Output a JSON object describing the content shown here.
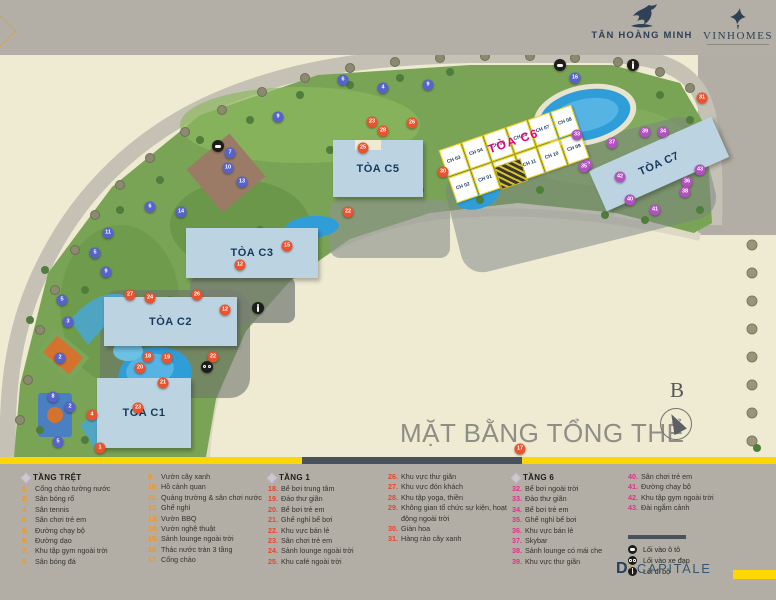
{
  "header": {
    "thm_logo": "TÂN HOÀNG MINH",
    "vinhomes_logo": "VINHOMES"
  },
  "map": {
    "title": "MẶT BẰNG TỔNG THỂ",
    "compass_label": "B",
    "buildings": {
      "c1": "TÒA C1",
      "c2": "TÒA C2",
      "c3": "TÒA C3",
      "c5": "TÒA C5",
      "c6": "TÒA C6",
      "c7": "TÒA C7"
    },
    "c6_units": [
      "CH 03",
      "CH 04",
      "CH 05",
      "CH 06",
      "CH 07",
      "CH 08",
      "CH 02",
      "CH 01",
      "CH 12",
      "CH 11",
      "CH 10",
      "CH 09"
    ],
    "markers": [
      {
        "c": "b",
        "n": "6",
        "x": 343,
        "y": 80
      },
      {
        "c": "b",
        "n": "4",
        "x": 383,
        "y": 88
      },
      {
        "c": "b",
        "n": "9",
        "x": 428,
        "y": 85
      },
      {
        "c": "b",
        "n": "9",
        "x": 278,
        "y": 117
      },
      {
        "c": "b",
        "n": "7",
        "x": 230,
        "y": 153
      },
      {
        "c": "b",
        "n": "10",
        "x": 228,
        "y": 168
      },
      {
        "c": "b",
        "n": "13",
        "x": 242,
        "y": 182
      },
      {
        "c": "b",
        "n": "6",
        "x": 150,
        "y": 207
      },
      {
        "c": "b",
        "n": "14",
        "x": 181,
        "y": 212
      },
      {
        "c": "b",
        "n": "11",
        "x": 108,
        "y": 233
      },
      {
        "c": "b",
        "n": "5",
        "x": 95,
        "y": 253
      },
      {
        "c": "b",
        "n": "9",
        "x": 106,
        "y": 272
      },
      {
        "c": "b",
        "n": "5",
        "x": 62,
        "y": 300
      },
      {
        "c": "b",
        "n": "3",
        "x": 68,
        "y": 322
      },
      {
        "c": "b",
        "n": "2",
        "x": 60,
        "y": 358
      },
      {
        "c": "b",
        "n": "8",
        "x": 53,
        "y": 397
      },
      {
        "c": "b",
        "n": "2",
        "x": 70,
        "y": 407
      },
      {
        "c": "b",
        "n": "5",
        "x": 58,
        "y": 442
      },
      {
        "c": "b",
        "n": "16",
        "x": 575,
        "y": 78
      },
      {
        "c": "o",
        "n": "23",
        "x": 372,
        "y": 122
      },
      {
        "c": "o",
        "n": "26",
        "x": 412,
        "y": 123
      },
      {
        "c": "o",
        "n": "28",
        "x": 383,
        "y": 131
      },
      {
        "c": "o",
        "n": "25",
        "x": 363,
        "y": 148
      },
      {
        "c": "o",
        "n": "30",
        "x": 443,
        "y": 172
      },
      {
        "c": "o",
        "n": "22",
        "x": 348,
        "y": 212
      },
      {
        "c": "o",
        "n": "12",
        "x": 240,
        "y": 265
      },
      {
        "c": "o",
        "n": "15",
        "x": 287,
        "y": 246
      },
      {
        "c": "o",
        "n": "27",
        "x": 130,
        "y": 295
      },
      {
        "c": "o",
        "n": "24",
        "x": 150,
        "y": 298
      },
      {
        "c": "o",
        "n": "26",
        "x": 197,
        "y": 295
      },
      {
        "c": "o",
        "n": "18",
        "x": 148,
        "y": 357
      },
      {
        "c": "o",
        "n": "19",
        "x": 167,
        "y": 358
      },
      {
        "c": "o",
        "n": "20",
        "x": 140,
        "y": 368
      },
      {
        "c": "o",
        "n": "21",
        "x": 163,
        "y": 383
      },
      {
        "c": "o",
        "n": "23",
        "x": 138,
        "y": 408
      },
      {
        "c": "o",
        "n": "4",
        "x": 92,
        "y": 415
      },
      {
        "c": "o",
        "n": "1",
        "x": 100,
        "y": 448
      },
      {
        "c": "o",
        "n": "22",
        "x": 213,
        "y": 357
      },
      {
        "c": "o",
        "n": "12",
        "x": 225,
        "y": 310
      },
      {
        "c": "o",
        "n": "31",
        "x": 702,
        "y": 98
      },
      {
        "c": "o",
        "n": "17",
        "x": 520,
        "y": 449
      },
      {
        "c": "p",
        "n": "33",
        "x": 577,
        "y": 135
      },
      {
        "c": "p",
        "n": "32",
        "x": 587,
        "y": 165
      },
      {
        "c": "p",
        "n": "37",
        "x": 612,
        "y": 143
      },
      {
        "c": "p",
        "n": "39",
        "x": 645,
        "y": 132
      },
      {
        "c": "p",
        "n": "34",
        "x": 663,
        "y": 132
      },
      {
        "c": "p",
        "n": "36",
        "x": 687,
        "y": 182
      },
      {
        "c": "p",
        "n": "38",
        "x": 685,
        "y": 192
      },
      {
        "c": "p",
        "n": "40",
        "x": 630,
        "y": 200
      },
      {
        "c": "p",
        "n": "41",
        "x": 655,
        "y": 210
      },
      {
        "c": "p",
        "n": "35",
        "x": 584,
        "y": 167
      },
      {
        "c": "p",
        "n": "42",
        "x": 620,
        "y": 177
      },
      {
        "c": "p",
        "n": "43",
        "x": 700,
        "y": 170
      },
      {
        "c": "k",
        "n": "car",
        "x": 218,
        "y": 146
      },
      {
        "c": "k",
        "n": "car",
        "x": 560,
        "y": 65
      },
      {
        "c": "k",
        "n": "walk",
        "x": 633,
        "y": 65
      },
      {
        "c": "k",
        "n": "walk",
        "x": 258,
        "y": 308
      },
      {
        "c": "k",
        "n": "bike",
        "x": 207,
        "y": 367
      }
    ]
  },
  "legend": {
    "columns": [
      {
        "header": "TẦNG TRỆT",
        "color": "#f7941d",
        "x": 22,
        "w": 122,
        "items": [
          {
            "n": "1.",
            "t": "Cổng chào tường nước"
          },
          {
            "n": "2.",
            "t": "Sân bóng rổ"
          },
          {
            "n": "3.",
            "t": "Sân tennis"
          },
          {
            "n": "4.",
            "t": "Sân chơi trẻ em"
          },
          {
            "n": "5.",
            "t": "Đường chạy bộ"
          },
          {
            "n": "6.",
            "t": "Đường dạo"
          },
          {
            "n": "7.",
            "t": "Khu tập gym ngoài trời"
          },
          {
            "n": "8.",
            "t": "Sân bóng đá"
          }
        ]
      },
      {
        "header": "",
        "color": "#f7941d",
        "x": 148,
        "w": 118,
        "items": [
          {
            "n": "9.",
            "t": "Vườn cây xanh"
          },
          {
            "n": "10.",
            "t": "Hồ cảnh quan"
          },
          {
            "n": "11.",
            "t": "Quảng trường & sân chơi nước"
          },
          {
            "n": "12.",
            "t": "Ghế nghỉ"
          },
          {
            "n": "13.",
            "t": "Vườn BBQ"
          },
          {
            "n": "14.",
            "t": "Vườn nghệ thuật"
          },
          {
            "n": "15.",
            "t": "Sảnh lounge ngoài trời"
          },
          {
            "n": "16.",
            "t": "Thác nước tràn 3 tầng"
          },
          {
            "n": "17.",
            "t": "Cổng chào"
          }
        ]
      },
      {
        "header": "TẦNG 1",
        "color": "#e8432e",
        "x": 268,
        "w": 118,
        "items": [
          {
            "n": "18.",
            "t": "Bể bơi trung tâm"
          },
          {
            "n": "19.",
            "t": "Đảo thư giãn"
          },
          {
            "n": "20.",
            "t": "Bể bơi trẻ em"
          },
          {
            "n": "21.",
            "t": "Ghế nghỉ bể bơi"
          },
          {
            "n": "22.",
            "t": "Khu vực bán lẻ"
          },
          {
            "n": "23.",
            "t": "Sân chơi trẻ em"
          },
          {
            "n": "24.",
            "t": "Sảnh lounge ngoài trời"
          },
          {
            "n": "25.",
            "t": "Khu café ngoài trời"
          }
        ]
      },
      {
        "header": "",
        "color": "#e8432e",
        "x": 388,
        "w": 122,
        "items": [
          {
            "n": "26.",
            "t": "Khu vực thư giãn"
          },
          {
            "n": "27.",
            "t": "Khu vực đón khách"
          },
          {
            "n": "28.",
            "t": "Khu tập yoga, thiền"
          },
          {
            "n": "29.",
            "t": "Không gian tổ chức sự kiện, hoạt động ngoài trời"
          },
          {
            "n": "30.",
            "t": "Giàn hoa"
          },
          {
            "n": "31.",
            "t": "Hàng rào cây xanh"
          }
        ]
      },
      {
        "header": "TẦNG 6",
        "color": "#e0308a",
        "x": 512,
        "w": 114,
        "items": [
          {
            "n": "32.",
            "t": "Bể bơi ngoài trời"
          },
          {
            "n": "33.",
            "t": "Đảo thư giãn"
          },
          {
            "n": "34.",
            "t": "Bể bơi trẻ em"
          },
          {
            "n": "35.",
            "t": "Ghế nghỉ bể bơi"
          },
          {
            "n": "36.",
            "t": "Khu vực bán lẻ"
          },
          {
            "n": "37.",
            "t": "Skybar"
          },
          {
            "n": "38.",
            "t": "Sảnh lounge có mái che"
          },
          {
            "n": "39.",
            "t": "Khu vực thư giãn"
          }
        ]
      },
      {
        "header": "",
        "color": "#e0308a",
        "x": 628,
        "w": 148,
        "items": [
          {
            "n": "40.",
            "t": "Sân chơi trẻ em"
          },
          {
            "n": "41.",
            "t": "Đường chạy bộ"
          },
          {
            "n": "42.",
            "t": "Khu tập gym ngoài trời"
          },
          {
            "n": "43.",
            "t": "Đài ngắm cảnh"
          }
        ]
      }
    ],
    "entries": [
      {
        "icon": "car-entry-icon",
        "glyph": "g-car",
        "label": "Lối vào ô tô"
      },
      {
        "icon": "bicycle-entry-icon",
        "glyph": "g-bike",
        "label": "Lối vào xe đạp"
      },
      {
        "icon": "pedestrian-entry-icon",
        "glyph": "g-walk",
        "label": "Lối đi bộ"
      }
    ]
  },
  "footer": {
    "brand_d": "D",
    "brand_apos": "’",
    "brand_rest": ".CAPITALE"
  }
}
